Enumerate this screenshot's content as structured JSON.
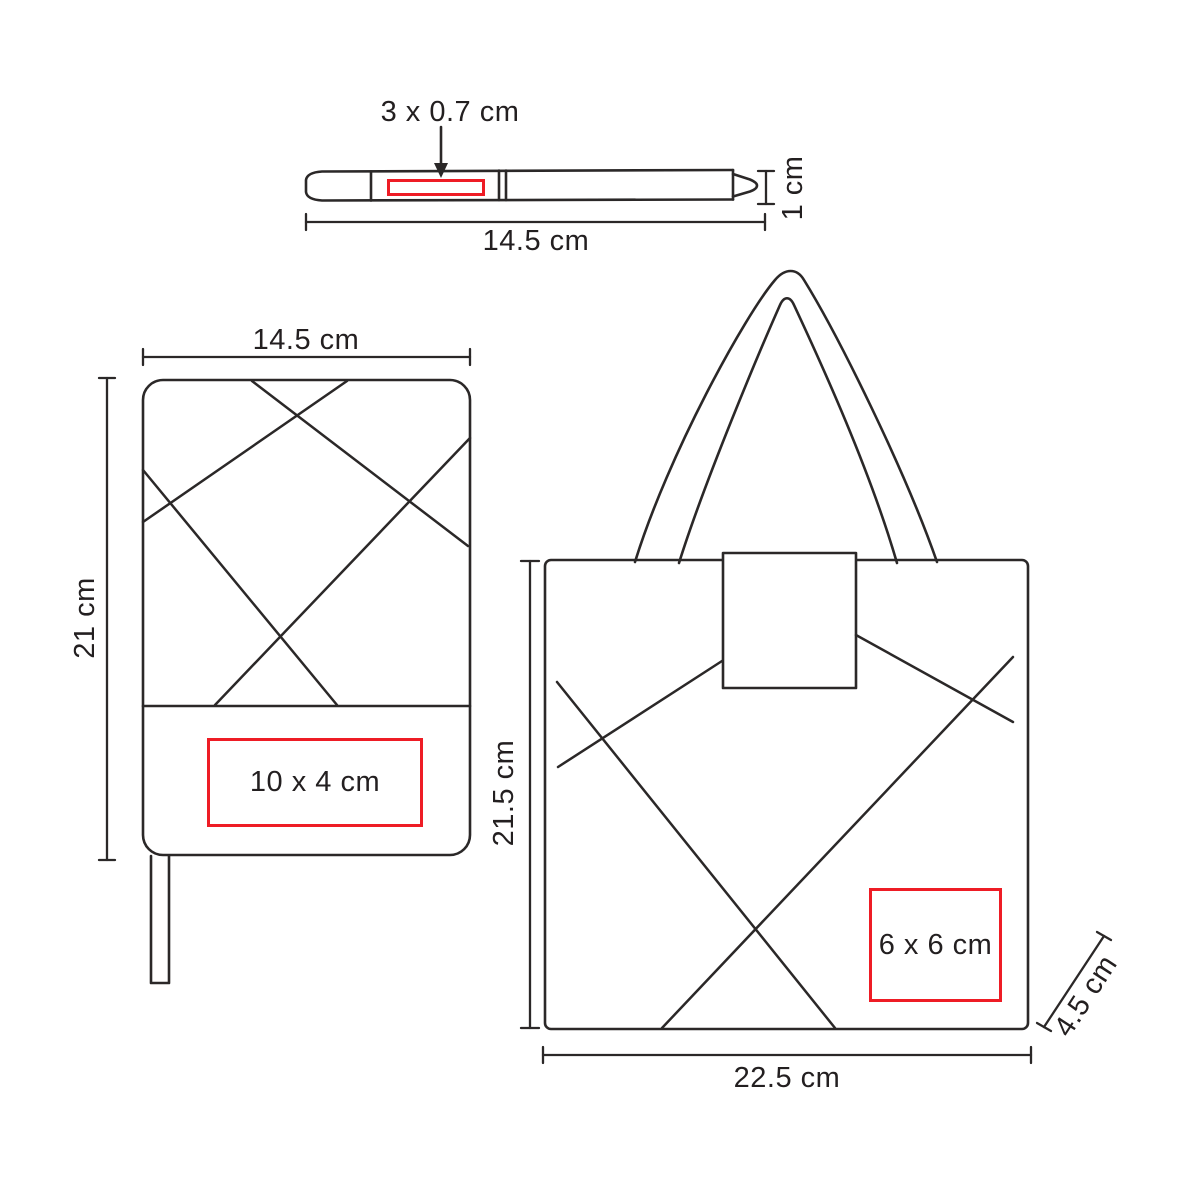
{
  "colors": {
    "line": "#2b2828",
    "accent_red": "#ee1c25",
    "text": "#231f20",
    "background": "#ffffff"
  },
  "pen": {
    "print_area": {
      "label": "3 x 0.7 cm"
    },
    "dimensions": {
      "length": "14.5 cm",
      "height": "1 cm"
    }
  },
  "notebook": {
    "print_area": {
      "label": "10 x 4 cm"
    },
    "dimensions": {
      "width": "14.5 cm",
      "height": "21 cm"
    }
  },
  "bag": {
    "print_area": {
      "label": "6 x 6 cm"
    },
    "dimensions": {
      "height": "21.5 cm",
      "width": "22.5 cm",
      "depth": "4.5 cm"
    }
  }
}
